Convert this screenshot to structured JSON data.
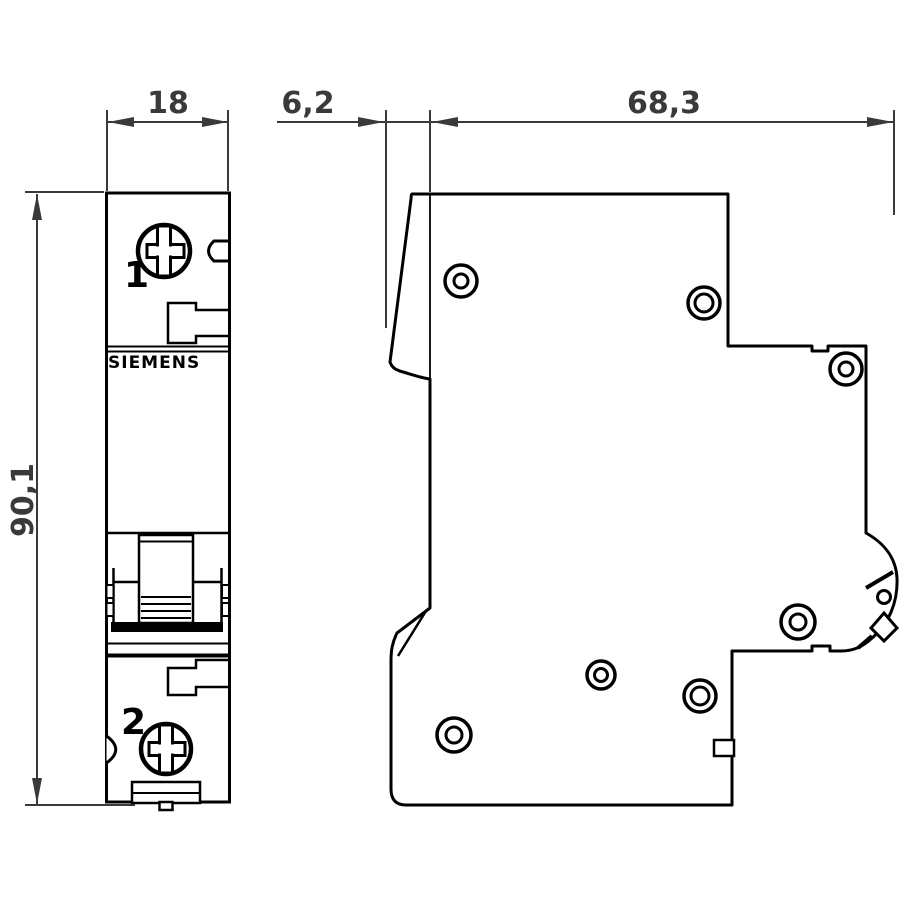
{
  "page": {
    "background": "#ffffff"
  },
  "drawing": {
    "kind": "circuit-breaker dimension drawing, front and side view",
    "front_view": {
      "brand_label": "SIEMENS",
      "terminal_top_label": "1",
      "terminal_bottom_label": "2"
    },
    "dimensions": {
      "width": "18",
      "toggle_protrusion": "6,2",
      "depth": "68,3",
      "height": "90,1"
    },
    "colors": {
      "outline": "#000000",
      "dimension": "#3a3a3a",
      "background": "#ffffff"
    }
  }
}
